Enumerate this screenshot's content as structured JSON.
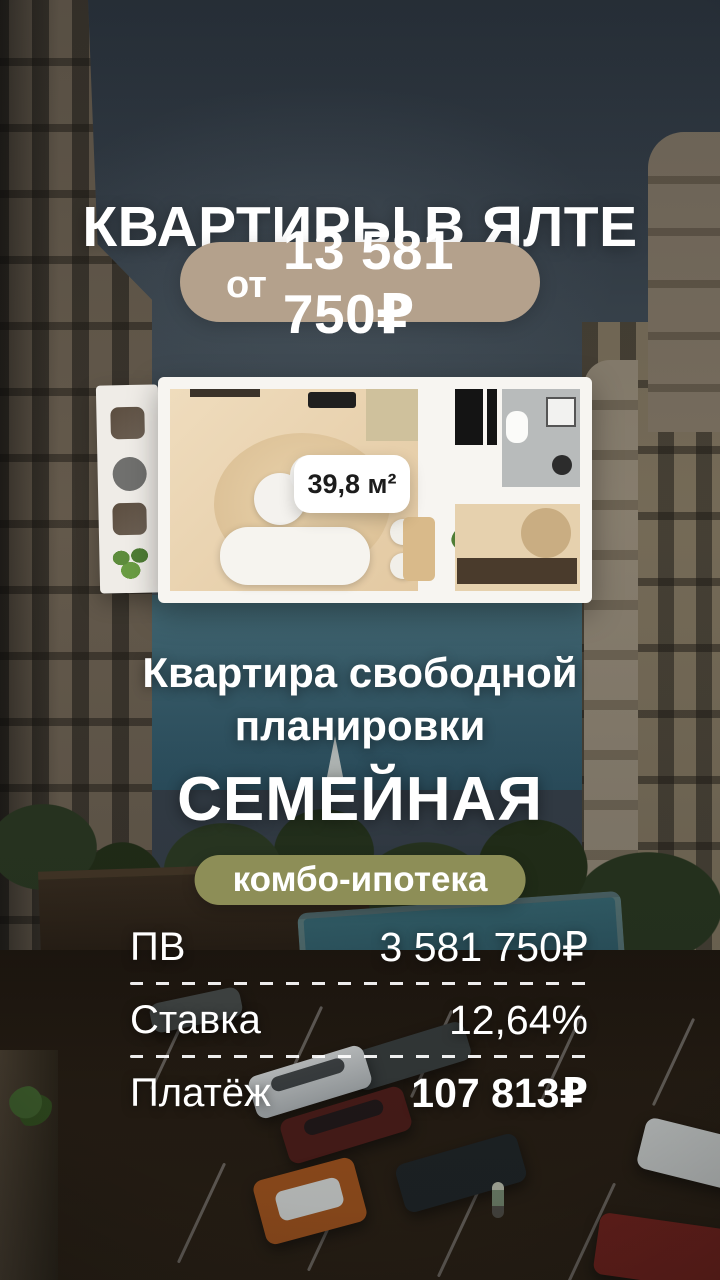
{
  "header": {
    "title": "КВАРТИРЫ В ЯЛТЕ",
    "price_badge": {
      "prefix": "от",
      "amount": "13 581 750₽"
    }
  },
  "floor_plan": {
    "area_label": "39,8 м²"
  },
  "subtitle": {
    "line1": "Квартира свободной",
    "line2": "планировки"
  },
  "program": {
    "name": "СЕМЕЙНАЯ",
    "badge_label": "комбо-ипотека"
  },
  "mortgage": {
    "rows": [
      {
        "label": "ПВ",
        "value": "3 581 750₽"
      },
      {
        "label": "Ставка",
        "value": "12,64%"
      },
      {
        "label": "Платёж",
        "value": "107 813₽"
      }
    ]
  },
  "colors": {
    "price_badge_bg": "#b4a18c",
    "program_badge_bg": "#8d8e57",
    "text": "#ffffff",
    "area_label_text": "#1c1c1c"
  }
}
